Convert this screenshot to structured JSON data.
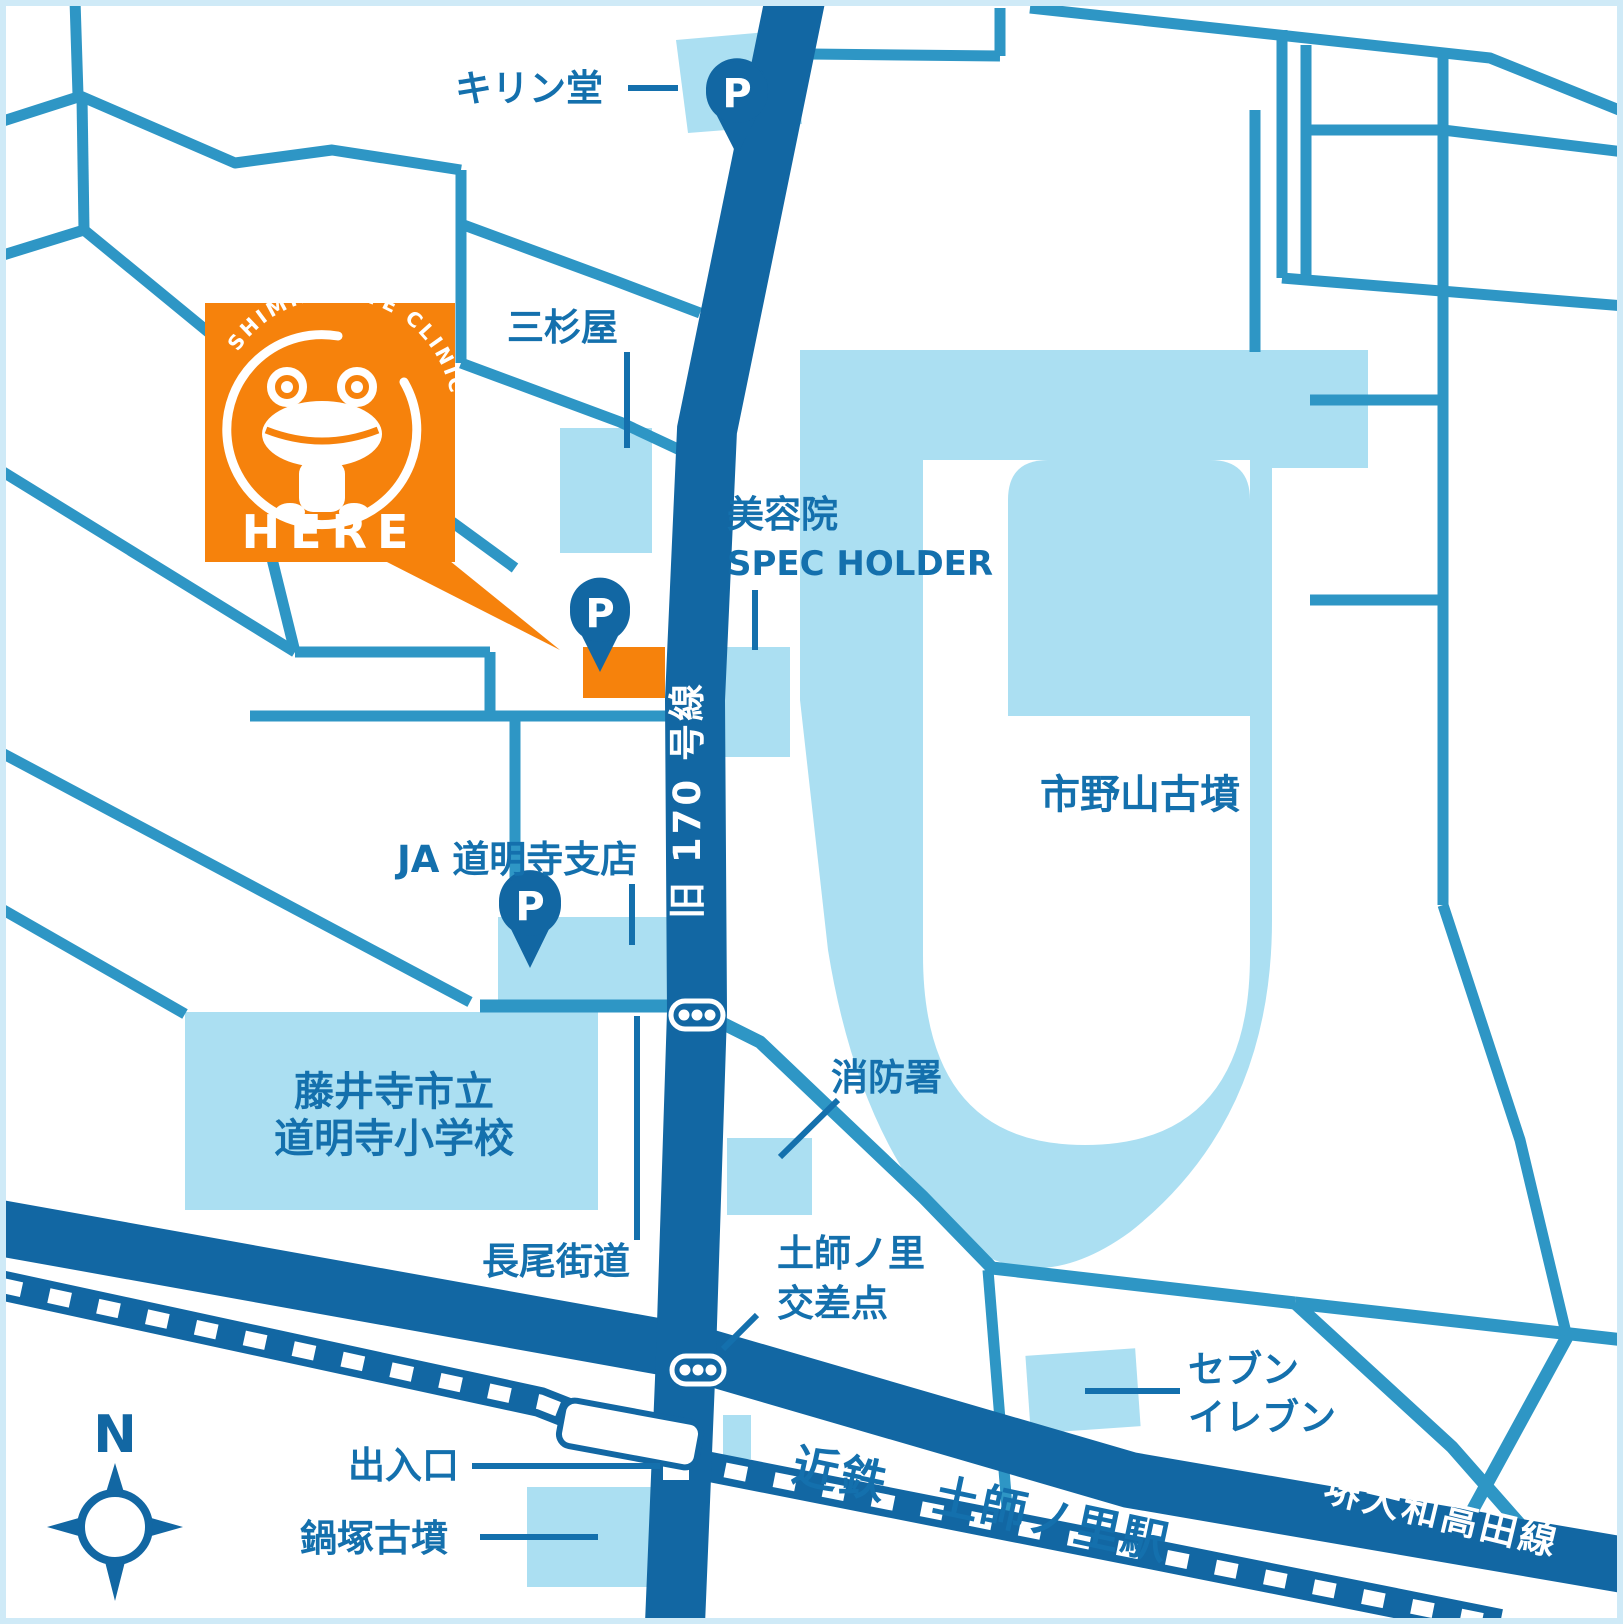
{
  "map": {
    "title": "clinic-access-map",
    "colors": {
      "road_dark": "#1267a3",
      "road_medium": "#2e96c5",
      "area_light": "#abdff2",
      "accent_orange": "#f6820c",
      "label_blue": "#1470ad",
      "background": "#ffffff",
      "border": "#cfeaf7"
    },
    "labels": {
      "kirindo": "キリン堂",
      "misugiya": "三杉屋",
      "biyoin": "美容院",
      "spec_holder": "SPEC HOLDER",
      "ichinoyama_kofun": "市野山古墳",
      "ja_domyoji": "JA 道明寺支店",
      "school_line1": "藤井寺市立",
      "school_line2": "道明寺小学校",
      "fire_station": "消防署",
      "nagao_kaido": "長尾街道",
      "hajinosato_line1": "土師ノ里",
      "hajinosato_line2": "交差点",
      "seven_line1": "セブン",
      "seven_line2": "イレブン",
      "deiriguchi": "出入口",
      "nabezuka_kofun": "鍋塚古墳",
      "kintetsu_station": "近鉄　土師ノ里駅",
      "sakai_yamato_takada": "堺大和高田線",
      "kyu_170": "旧 170 号線",
      "parking": "P",
      "here": "HERE",
      "clinic_arc": "SHIMIZU EYE CLINIC",
      "compass_north": "N"
    }
  }
}
